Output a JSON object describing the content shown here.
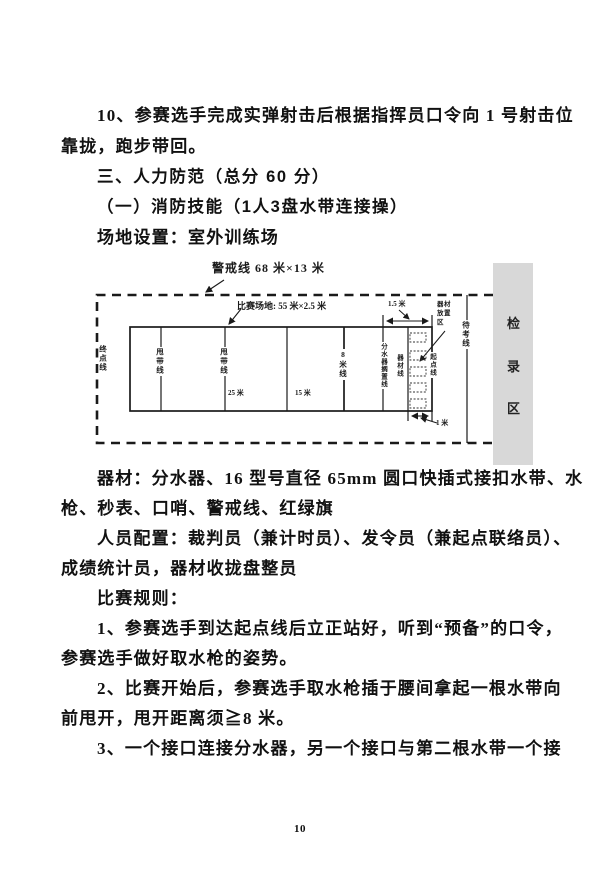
{
  "document": {
    "body_top": [
      {
        "text": "10、参赛选手完成实弹射击后根据指挥员口令向 1 号射击位"
      },
      {
        "text": "靠拢，跑步带回。"
      },
      {
        "text": "三、人力防范（总分 60 分）"
      },
      {
        "text": "（一）消防技能（1人3盘水带连接操）"
      },
      {
        "text": "场地设置：室外训练场"
      }
    ],
    "body_bottom": [
      {
        "text": "器材：分水器、16 型号直径 65mm 圆口快插式接扣水带、水"
      },
      {
        "text": "枪、秒表、口哨、警戒线、红绿旗"
      },
      {
        "text": "人员配置：裁判员（兼计时员）、发令员（兼起点联络员）、"
      },
      {
        "text": "成绩统计员，器材收拢盘整员"
      },
      {
        "text": "比赛规则："
      },
      {
        "text": "1、参赛选手到达起点线后立正站好，听到“预备”的口令，"
      },
      {
        "text": "参赛选手做好取水枪的姿势。"
      },
      {
        "text": "2、比赛开始后，参赛选手取水枪插于腰间拿起一根水带向"
      },
      {
        "text": "前甩开，甩开距离须≧8 米。"
      },
      {
        "text": "3、一个接口连接分水器，另一个接口与第二根水带一个接"
      }
    ],
    "page_number": "10"
  },
  "diagram": {
    "warning_label": "警戒线  68 米×13 米",
    "field_label": "比赛场地: 55 米×2.5 米",
    "finish_line_label": "终点线",
    "throw_line1_label": "甩带线",
    "throw_line2_label": "甩带线",
    "segment1_label": "25 米",
    "segment2_label": "15 米",
    "eight_meter_line_label": "8米线",
    "divider_line_label": "分水器搁置线",
    "equipment_line_label": "器材线",
    "start_line_label": "起点线",
    "waiting_line_label": "待考线",
    "equipment_area_label": "器材放置区",
    "checkin": {
      "char1": "检",
      "char2": "录",
      "char3": "区"
    },
    "dim_top_label": "1.5 米",
    "dim_bottom_label": "1 米",
    "colors": {
      "checkin_bg": "#d8d8d8",
      "line": "#1a1a1a"
    }
  }
}
